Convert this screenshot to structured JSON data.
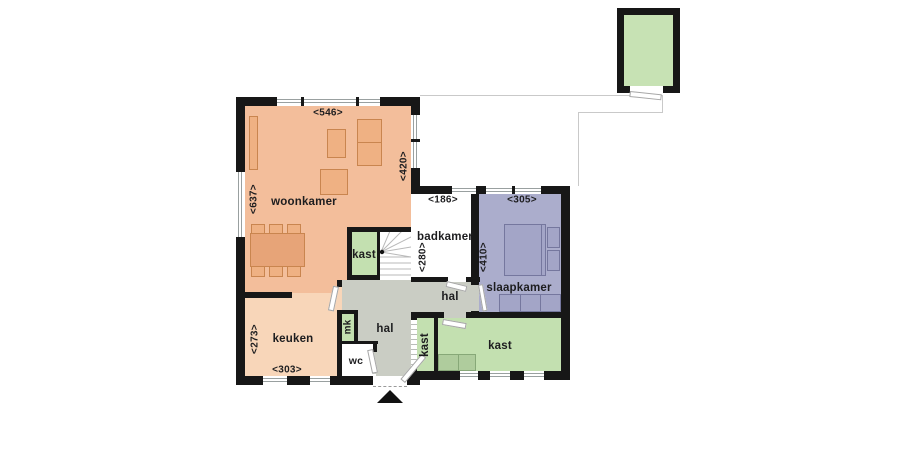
{
  "plan": {
    "type": "floor-plan",
    "rooms": {
      "woonkamer": {
        "label": "woonkamer",
        "dim_top": "<546>",
        "dim_left": "<637>",
        "dim_right": "<420>"
      },
      "keuken": {
        "label": "keuken",
        "dim_left": "<273>",
        "dim_bottom": "<303>"
      },
      "badkamer": {
        "label": "badkamer",
        "dim_top": "<186>",
        "dim_left": "<280>"
      },
      "slaapkamer": {
        "label": "slaapkamer",
        "dim_top": "<305>",
        "dim_left": "<410>"
      },
      "hal_center": {
        "label": "hal"
      },
      "hal_right": {
        "label": "hal"
      },
      "kast_stairs": {
        "label": "kast"
      },
      "kast_hall": {
        "label": "kast"
      },
      "kast_bedroom": {
        "label": "kast"
      },
      "wc": {
        "label": "wc"
      },
      "mk": {
        "label": "mk"
      }
    },
    "icons": {
      "entrance_arrow": "triangle-up"
    },
    "colors": {
      "wall": "#171717",
      "living_floor": "#F3BE9B",
      "kitchen_floor": "#F8D6B9",
      "bedroom_floor": "#ABADCC",
      "closet_floor": "#C3E0B0",
      "hall_floor": "#CACDC4",
      "furniture_orange": "#EFB183",
      "furniture_purple": "#A3A5C7",
      "shed_floor": "#C7E2B4",
      "boundary_line": "#c9c9c9"
    }
  }
}
